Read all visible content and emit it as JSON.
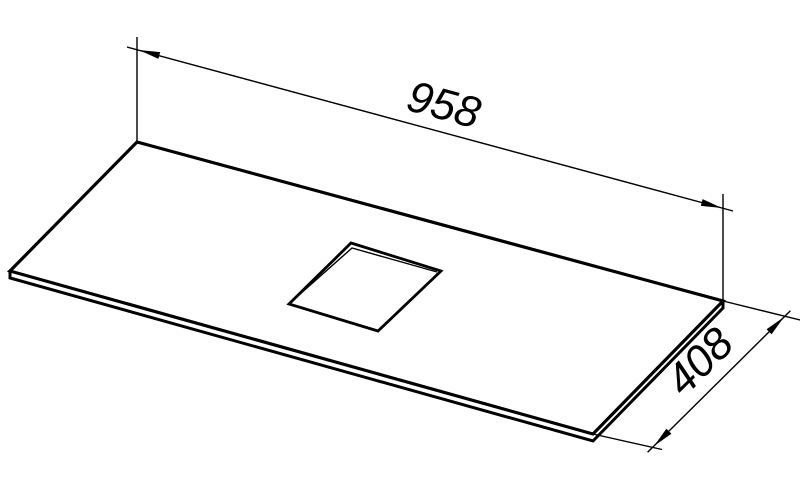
{
  "page": {
    "background_color": "#ffffff",
    "line_color": "#000000"
  },
  "drawing": {
    "description": "Isometric technical line drawing of a thin rectangular countertop panel with a centered square cutout",
    "dimensions": {
      "length": {
        "value": "958"
      },
      "depth": {
        "value": "408"
      }
    }
  }
}
